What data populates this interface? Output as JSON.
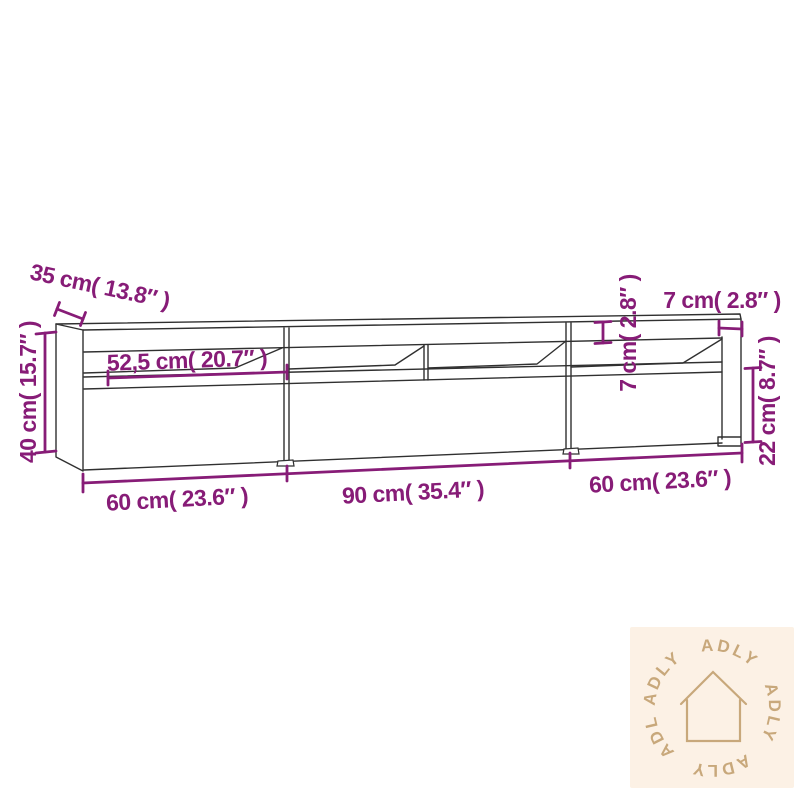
{
  "page": {
    "background": "#ffffff"
  },
  "diagram": {
    "subject": "tv-cabinet-with-open-shelves",
    "outline_color": "#303030",
    "dimension_color": "#871c77",
    "labels": {
      "depth_top": "35 cm( 13.8″ )",
      "height_total": "40 cm( 15.7″ )",
      "shelf_width_left": "52,5 cm( 20.7″ )",
      "top_panel_height": "7 cm( 2.8″ )",
      "top_depth_right": "7 cm( 2.8″ )",
      "drawer_height": "22 cm( 8.7″ )",
      "width_left": "60 cm( 23.6″ )",
      "width_middle": "90 cm( 35.4″ )",
      "width_right": "60 cm( 23.6″ )"
    }
  },
  "watermark": {
    "brand": "ADLY",
    "ring_text": "ADLY ADLY ADLY ADLY ADLY",
    "bg_color": "#fcf1e5",
    "fg_color": "#c8a87b"
  }
}
